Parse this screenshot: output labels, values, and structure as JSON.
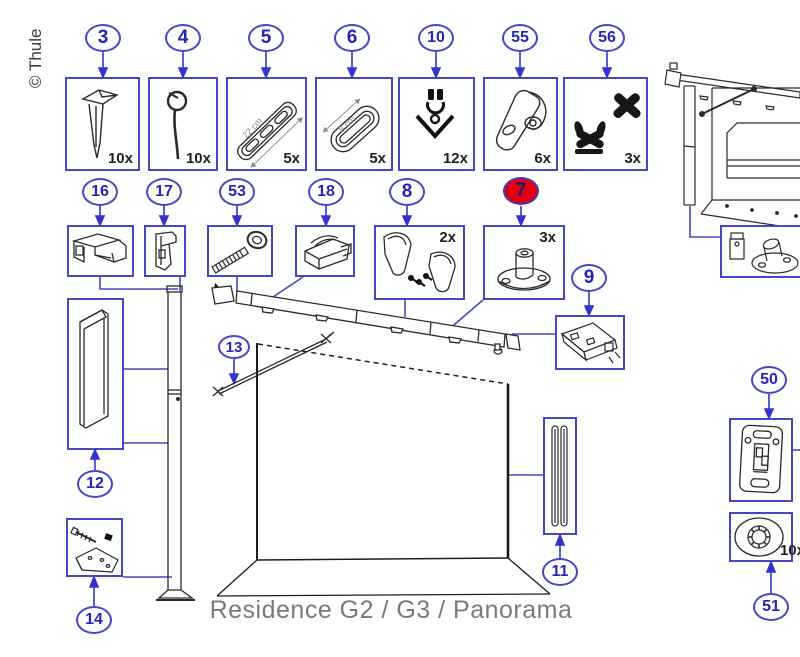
{
  "caption": "Residence G2 / G3 / Panorama",
  "copyright": "© Thule",
  "colors": {
    "accent": "#4646c8",
    "highlight": "#e3000f",
    "ink": "#2a2a2a",
    "muted": "#7a7a7a"
  },
  "parts": {
    "p3": {
      "number": "3",
      "qty": "10x"
    },
    "p4": {
      "number": "4",
      "qty": "10x"
    },
    "p5": {
      "number": "5",
      "qty": "5x",
      "dimension": "22 cm"
    },
    "p6": {
      "number": "6",
      "qty": "5x",
      "dimension": "8 cm"
    },
    "p10": {
      "number": "10",
      "qty": "12x"
    },
    "p55": {
      "number": "55",
      "qty": "6x"
    },
    "p56": {
      "number": "56",
      "qty": "3x"
    },
    "p16": {
      "number": "16"
    },
    "p17": {
      "number": "17"
    },
    "p53": {
      "number": "53"
    },
    "p18": {
      "number": "18"
    },
    "p8": {
      "number": "8",
      "qty": "2x"
    },
    "p7": {
      "number": "7",
      "qty": "3x",
      "highlighted": true
    },
    "p9": {
      "number": "9"
    },
    "p12": {
      "number": "12"
    },
    "p13": {
      "number": "13"
    },
    "p14": {
      "number": "14"
    },
    "p11": {
      "number": "11"
    },
    "p50": {
      "number": "50"
    },
    "p51": {
      "number": "51",
      "qty": "10x"
    }
  }
}
